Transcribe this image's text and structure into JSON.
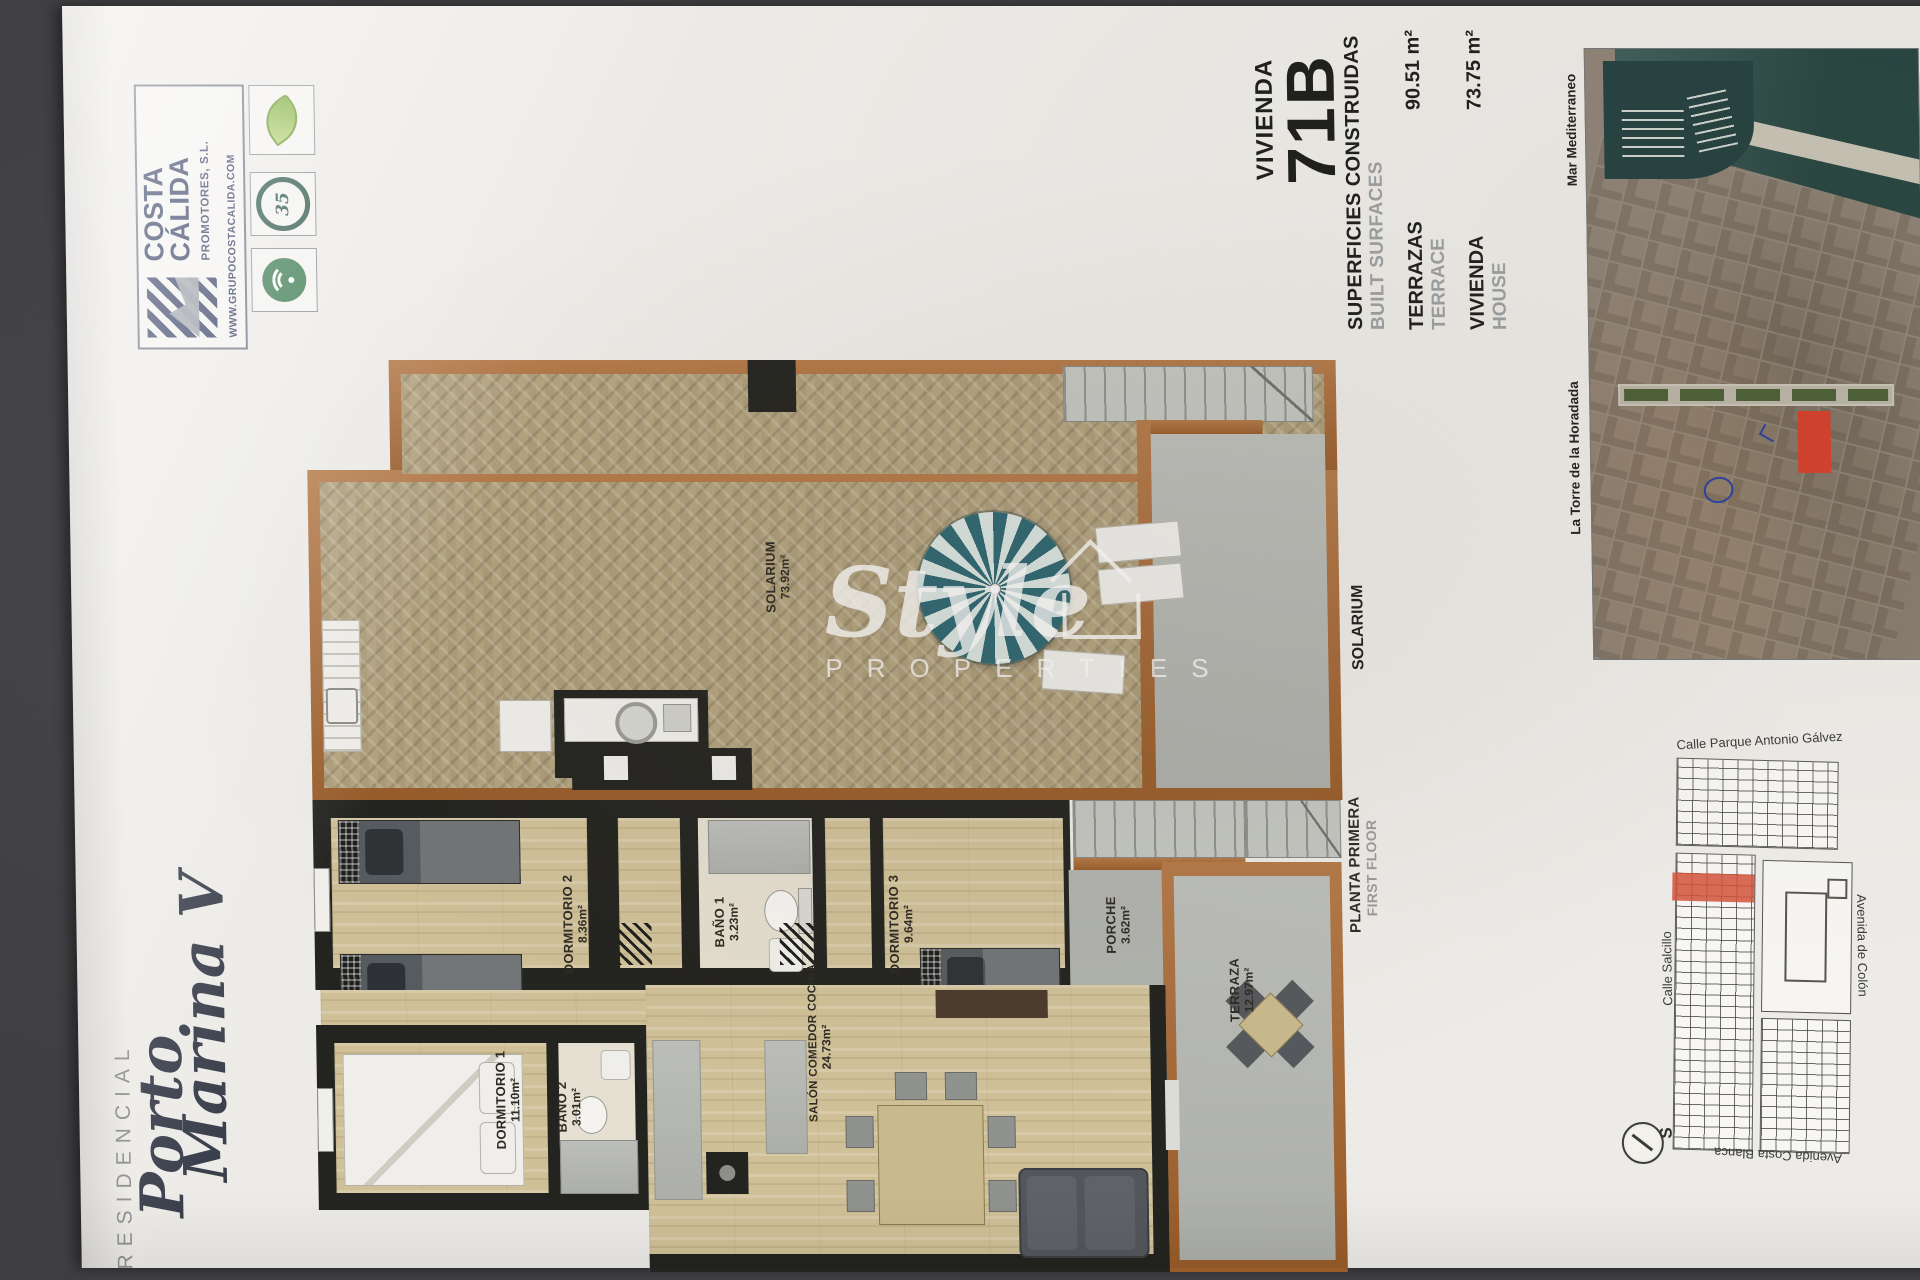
{
  "branding": {
    "company_name_line1": "COSTA",
    "company_name_line2": "CÁLIDA",
    "company_suffix": "PROMOTORES, S.L.",
    "website": "WWW.GRUPOCOSTACALIDA.COM",
    "badge_years": "35"
  },
  "project": {
    "label": "RESIDENCIAL",
    "name_line1": "Porto",
    "name_line2": "Marina V"
  },
  "unit": {
    "label": "VIVIENDA",
    "number": "71B"
  },
  "surfaces": {
    "header_es": "SUPERFICIES CONSTRUIDAS",
    "header_en": "BUILT SURFACES",
    "row1_es": "TERRAZAS",
    "row1_en": "TERRACE",
    "row1_value": "90.51 m²",
    "row2_es": "VIVIENDA",
    "row2_en": "HOUSE",
    "row2_value": "73.75 m²"
  },
  "solarium": {
    "side_label": "SOLARIUM",
    "room_name": "SOLARIUM",
    "room_area": "73.92m²"
  },
  "floor1": {
    "title_es": "PLANTA PRIMERA",
    "title_en": "FIRST FLOOR",
    "rooms": {
      "dorm2": {
        "name": "DORMITORIO 2",
        "area": "8.36m²"
      },
      "bano1": {
        "name": "BAÑO 1",
        "area": "3.23m²"
      },
      "dorm3": {
        "name": "DORMITORIO 3",
        "area": "9.64m²"
      },
      "porche": {
        "name": "PORCHE",
        "area": "3.62m²"
      },
      "terraza": {
        "name": "TERRAZA",
        "area": "12.97m²"
      },
      "dorm1": {
        "name": "DORMITORIO 1",
        "area": "11.10m²"
      },
      "bano2": {
        "name": "BAÑO 2",
        "area": "3.01m²"
      },
      "salon": {
        "name": "SALÓN COMEDOR COCINA",
        "area": "24.73m²"
      }
    }
  },
  "location_map": {
    "sea": "Mar Mediterraneo",
    "town": "La Torre de la Horadada"
  },
  "site_map": {
    "street_top": "Calle Parque Antonio Gálvez",
    "street_left": "Calle Salcillo",
    "street_right": "Avenida de Colón",
    "street_bottom": "Avenida Costa Blanca",
    "compass": "S"
  },
  "watermark": {
    "name": "Style",
    "subtitle": "PROPERTIES"
  },
  "colors": {
    "accent_red": "#d43f2a",
    "wall_brown": "#a9662e",
    "logo_navy": "#3a4468",
    "eco_green": "#8ab54a",
    "sea_teal": "#2f5a57"
  }
}
